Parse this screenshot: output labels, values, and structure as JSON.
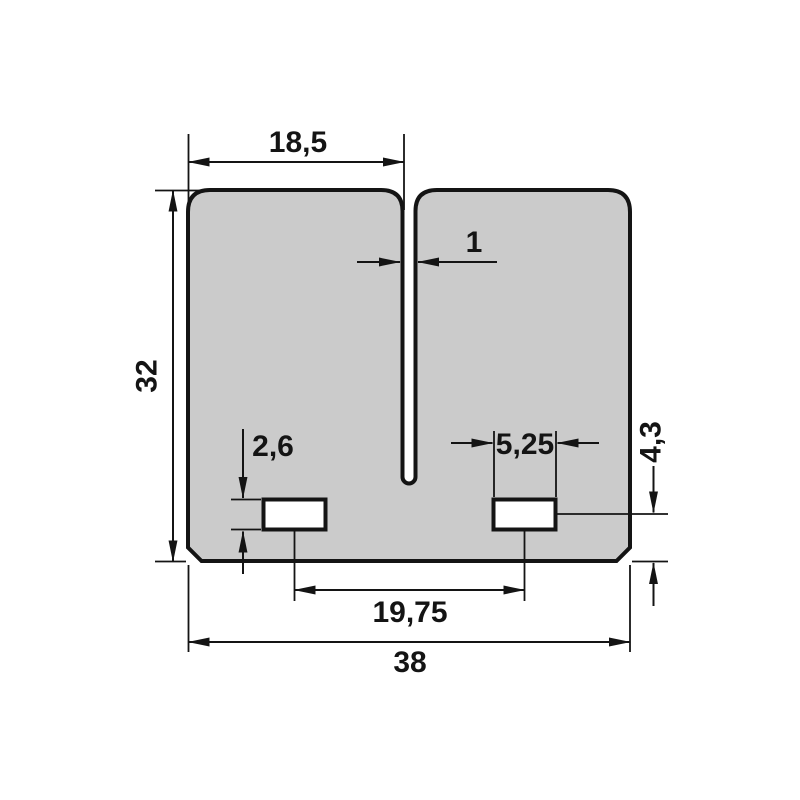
{
  "drawing": {
    "dimension_labels": {
      "top_width": "18,5",
      "slot_width": "1",
      "overall_height": "32",
      "hole_height": "2,6",
      "hole_width": "5,25",
      "hole_to_bottom": "4,3",
      "hole_spacing": "19,75",
      "overall_width": "38"
    },
    "colors": {
      "background": "#ffffff",
      "outline": "#141414",
      "part_fill": "#cbcbcb",
      "hole_fill": "#ffffff"
    }
  }
}
